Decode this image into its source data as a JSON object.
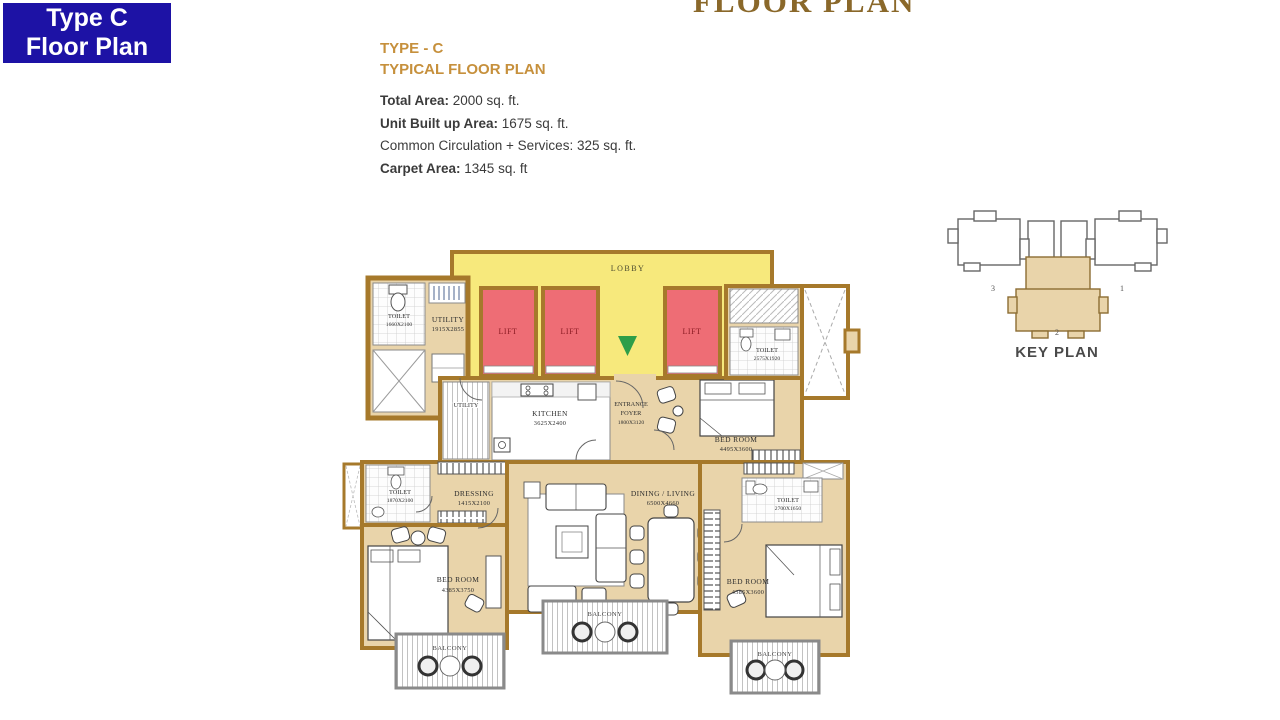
{
  "badge": {
    "line1": "Type C",
    "line2": "Floor Plan"
  },
  "page_title": "FLOOR PLAN",
  "plan_header": {
    "title_line1": "TYPE - C",
    "title_line2": "TYPICAL FLOOR PLAN"
  },
  "area_details": [
    {
      "label": "Total Area:",
      "value": " 2000 sq. ft."
    },
    {
      "label": "Unit Built up Area:",
      "value": " 1675 sq. ft."
    },
    {
      "label": "Common Circulation + Services:",
      "value": " 325 sq. ft."
    },
    {
      "label": "Carpet Area:",
      "value": " 1345 sq. ft"
    }
  ],
  "floor_plan": {
    "lobby": "LOBBY",
    "lift": "LIFT",
    "utility1": {
      "name": "UTILITY",
      "dim": "1915X2855"
    },
    "toilet1": {
      "name": "TOILET",
      "dim": "1660X2100"
    },
    "utility2": {
      "name": "UTILITY"
    },
    "kitchen": {
      "name": "KITCHEN",
      "dim": "3625X2400"
    },
    "entrance_foyer": {
      "line1": "ENTRANCE",
      "line2": "FOYER",
      "dim": "1800X3120"
    },
    "bedroom1": {
      "name": "BED ROOM",
      "dim": "4495X3600"
    },
    "toilet2": {
      "name": "TOILET",
      "dim": "2575X1920"
    },
    "toilet3": {
      "name": "TOILET",
      "dim": "1870X2100"
    },
    "dressing": {
      "name": "DRESSING",
      "dim": "1415X2100"
    },
    "bedroom2": {
      "name": "BED ROOM",
      "dim": "4385X3750"
    },
    "dining_living": {
      "name": "DINING / LIVING",
      "dim": "6500X4660"
    },
    "bedroom3": {
      "name": "BED ROOM",
      "dim": "4385X3600"
    },
    "toilet4": {
      "name": "TOILET",
      "dim": "2700X1650"
    },
    "balcony": "BALCONY"
  },
  "key_plan": {
    "title": "KEY PLAN",
    "wing1": "1",
    "wing2": "2",
    "wing3": "3"
  },
  "colors": {
    "badge_bg": "#1d12a5",
    "heading_gold": "#c6903c",
    "title_gold": "#8a682a",
    "lobby_yellow": "#f7e97c",
    "lift_red": "#ee6d75",
    "wall_brown": "#a6792b",
    "floor_tan": "#e9d4aa",
    "arrow_green": "#2e9e49"
  }
}
